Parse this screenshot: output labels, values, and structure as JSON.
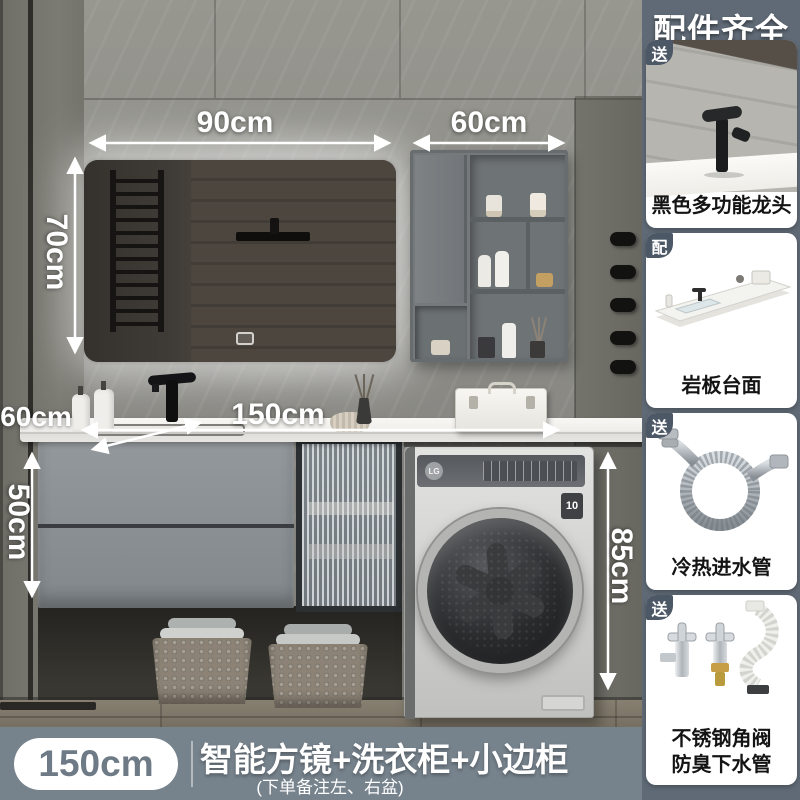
{
  "annotations": {
    "mirror_width": "90cm",
    "cabinet_width": "60cm",
    "mirror_height": "70cm",
    "counter_length": "150cm",
    "counter_depth": "60cm",
    "vanity_height": "50cm",
    "washer_height": "85cm"
  },
  "washer": {
    "logo": "LG",
    "badge": "10"
  },
  "sidebar": {
    "title": "配件齐全",
    "panels": [
      {
        "badge": "送",
        "caption": "黑色多功能龙头"
      },
      {
        "badge": "配",
        "caption": "岩板台面"
      },
      {
        "badge": "送",
        "caption": "冷热进水管"
      },
      {
        "badge": "送",
        "caption": "不锈钢角阀",
        "caption2": "防臭下水管"
      }
    ]
  },
  "footer": {
    "size": "150cm",
    "title": "智能方镜+洗衣柜+小边柜",
    "subtitle": "(下单备注左、右盆)"
  },
  "colors": {
    "footer_bar": "#76828C",
    "sidebar_strip": "#5F6A76",
    "badge": "#4D5866",
    "pill_text": "#6E7A85"
  }
}
